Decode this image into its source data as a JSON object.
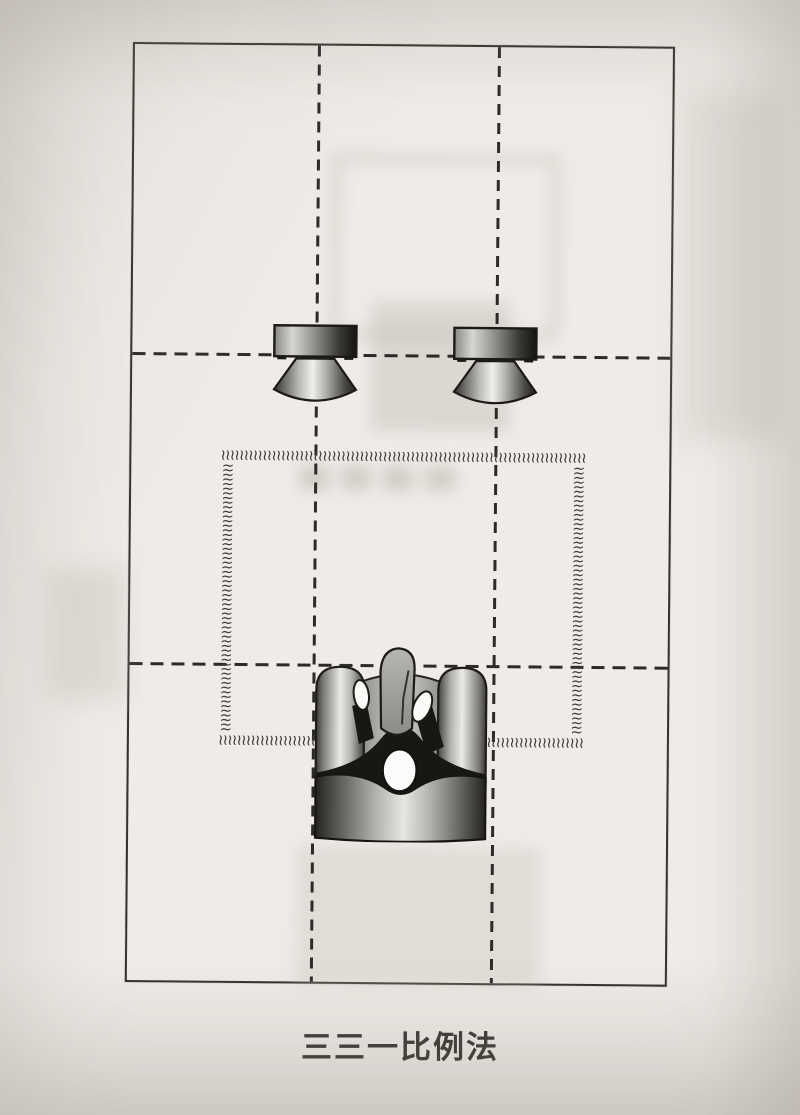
{
  "caption": "三三一比例法",
  "diagram": {
    "zigzag_glyph": "≀",
    "colors": {
      "paper": "#efece8",
      "ink": "#2c2b28"
    },
    "elements": {
      "left_speaker": "speaker-top-view-icon",
      "right_speaker": "speaker-top-view-icon",
      "listener": "listener-in-armchair-icon",
      "listening_area": "zigzag-border-rectangle",
      "room": "room-outline-with-thirds-grid"
    }
  }
}
